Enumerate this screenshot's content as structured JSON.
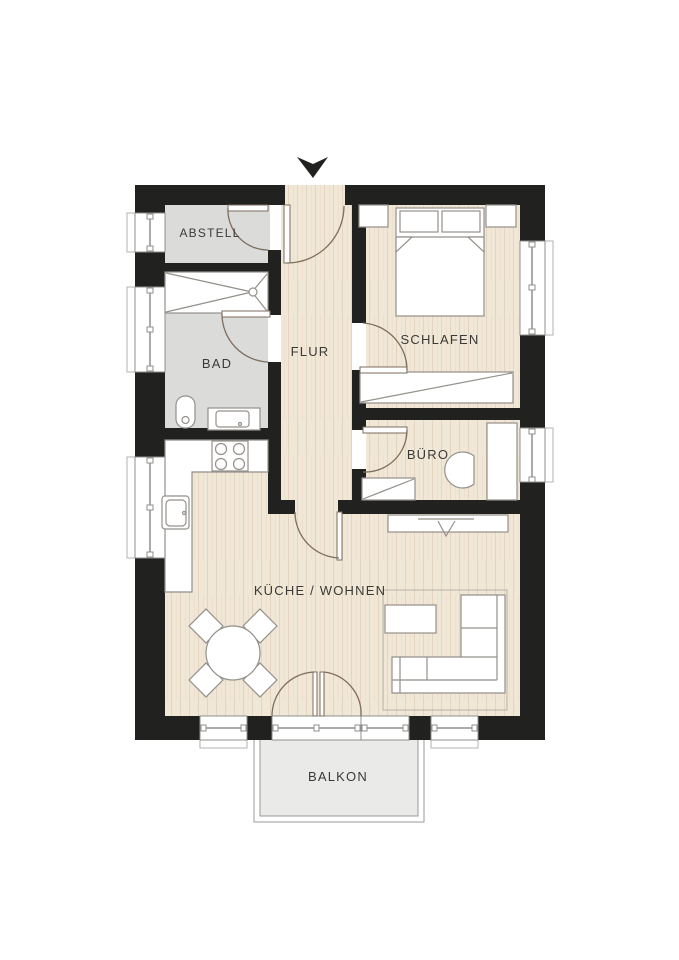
{
  "plan": {
    "type": "apartment-floor-plan",
    "rooms": [
      {
        "id": "abstell",
        "label": "ABSTELL"
      },
      {
        "id": "bad",
        "label": "BAD"
      },
      {
        "id": "flur",
        "label": "FLUR"
      },
      {
        "id": "schlafen",
        "label": "SCHLAFEN"
      },
      {
        "id": "buero",
        "label": "BÜRO"
      },
      {
        "id": "kueche-wohnen",
        "label": "KÜCHE / WOHNEN"
      },
      {
        "id": "balkon",
        "label": "BALKON"
      }
    ],
    "colors": {
      "background": "#ffffff",
      "wall": "#21211f",
      "wood_floor": "#f1e7d6",
      "wood_grain": "#e3d5bf",
      "wet_room_floor": "#dbdbd9",
      "balcony_floor": "#eaeae8",
      "furniture_fill": "#ffffff",
      "furniture_stroke": "#94908a",
      "door_arc": "#7e6e5d",
      "label_text": "#3a3a38"
    },
    "icons": {
      "entrance_arrow": "triangle-down"
    }
  }
}
